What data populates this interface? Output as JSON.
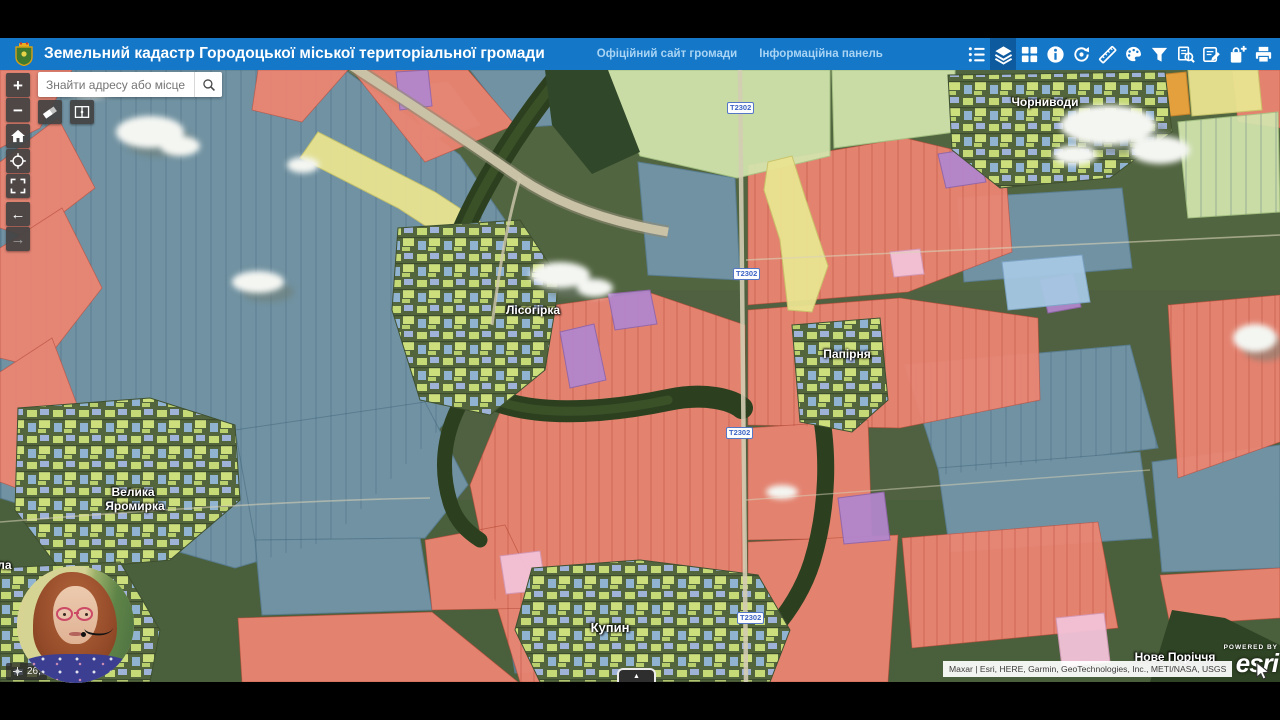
{
  "header": {
    "bg_color": "#1477c8",
    "logo": "coat-of-arms",
    "title": "Земельний кадастр Городоцької міської територіальної громади",
    "links": [
      {
        "label": "Офіційний сайт громади"
      },
      {
        "label": "Інформаційна панель"
      }
    ],
    "toolbar_icons": [
      {
        "name": "legend-list",
        "active": false
      },
      {
        "name": "layers",
        "active": true
      },
      {
        "name": "basemap-gallery",
        "active": false
      },
      {
        "name": "info",
        "active": false
      },
      {
        "name": "sync",
        "active": false
      },
      {
        "name": "measure",
        "active": false
      },
      {
        "name": "draw-palette",
        "active": false
      },
      {
        "name": "filter",
        "active": false
      },
      {
        "name": "query-search",
        "active": false
      },
      {
        "name": "edit-notes",
        "active": false
      },
      {
        "name": "add-data",
        "active": false
      },
      {
        "name": "print",
        "active": false
      }
    ]
  },
  "search": {
    "placeholder": "Знайти адресу або місце",
    "value": "",
    "icon": "search-magnifier"
  },
  "map_controls": {
    "zoom_in": "+",
    "zoom_out": "−",
    "back_arrow": "←",
    "forward_arrow": "→",
    "buttons": [
      "home",
      "locate",
      "fullscreen"
    ],
    "tools": [
      "eraser",
      "swipe"
    ]
  },
  "map": {
    "places": [
      {
        "name": "Чорниводи"
      },
      {
        "name": "Лісогірка"
      },
      {
        "name": "Папірня"
      },
      {
        "line1": "Велика",
        "line2": "Яромирка"
      },
      {
        "name": "Купин"
      },
      {
        "name": "Мала"
      },
      {
        "name": "Нове Поріччя"
      }
    ],
    "road_shields": [
      {
        "label": "Т2302"
      },
      {
        "label": "Т2302"
      },
      {
        "label": "Т2302"
      },
      {
        "label": "Т2302"
      }
    ],
    "parcel_colors": {
      "salmon": "#ed8572",
      "slate_blue": "#7496aa",
      "light_green": "#d2e5ae",
      "yellow": "#e9e491",
      "purple": "#b286cc",
      "pink": "#f3c3d8",
      "light_blue": "#a6c8e4",
      "orange": "#eba43c"
    }
  },
  "status": {
    "coordinates": "26,"
  },
  "attribution": {
    "text": "Maxar | Esri, HERE, Garmin, GeoTechnologies, Inc., METI/NASA, USGS"
  },
  "esri": {
    "powered_by": "POWERED BY",
    "brand": "esri"
  },
  "panel_handle": {
    "glyph": "▲"
  }
}
